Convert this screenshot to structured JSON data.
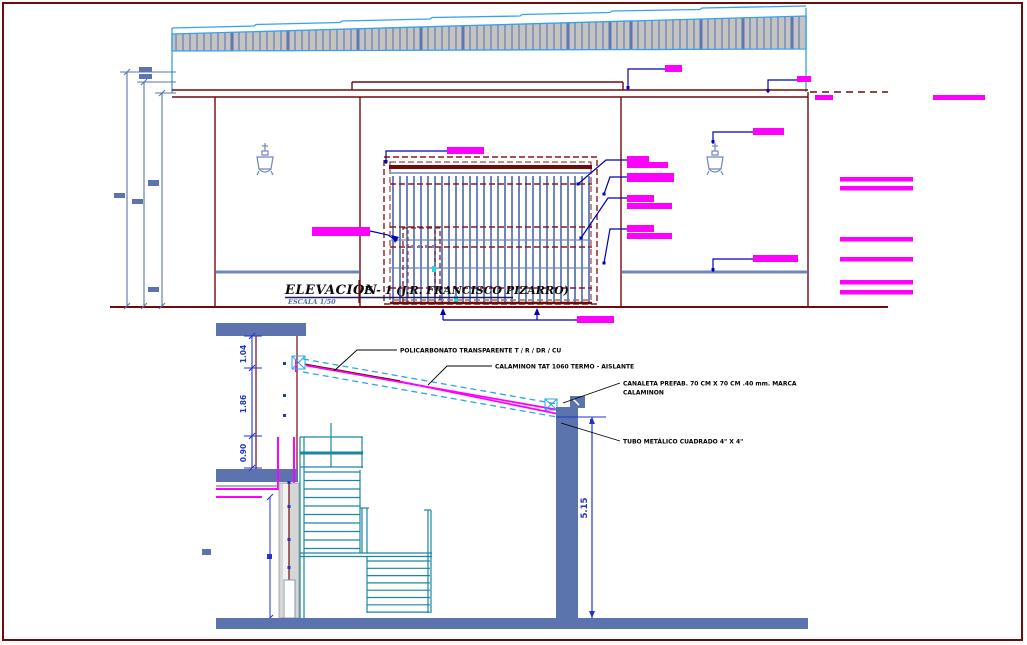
{
  "sheet": {
    "background": "#ffffff",
    "border_color": "#6e0b0b"
  },
  "elevation": {
    "title_left": "ELEVACION",
    "title_right": "E - 1 (J.R. FRANCISCO PIZARRO)",
    "scale_note": "ESCALA 1/50",
    "colors": {
      "walls": "#6e0b0b",
      "roof_outline": "#35a2ee",
      "roof_fill": "#c6c4c0",
      "roof_hatch": "#5b77b8",
      "steel_bars": "#6f86bd",
      "callout_block": "#ff00ff",
      "leader": "#0000bb"
    }
  },
  "section": {
    "labels": {
      "polycarbonate": "POLICARBONATO TRANSPARENTE T / R / DR / CU",
      "roof_panel": "CALAMINON TAT 1060 TERMO - AISLANTE",
      "gutter_line1": "CANALETA PREFAB. 70 CM X 70 CM .40 mm. MARCA",
      "gutter_line2": "CALAMINON",
      "tube": "TUBO METÁLICO CUADRADO 4\" X 4\""
    },
    "dimensions": {
      "parapet": "1.04",
      "wall": "1.86",
      "sill": "0.90",
      "column_height": "5.15"
    },
    "colors": {
      "structure": "#5b74ae",
      "stairs": "#1a86a2",
      "slope_outline": "#2aa7e8",
      "membrane": "#ff00ff",
      "dimension": "#2233cc"
    }
  }
}
